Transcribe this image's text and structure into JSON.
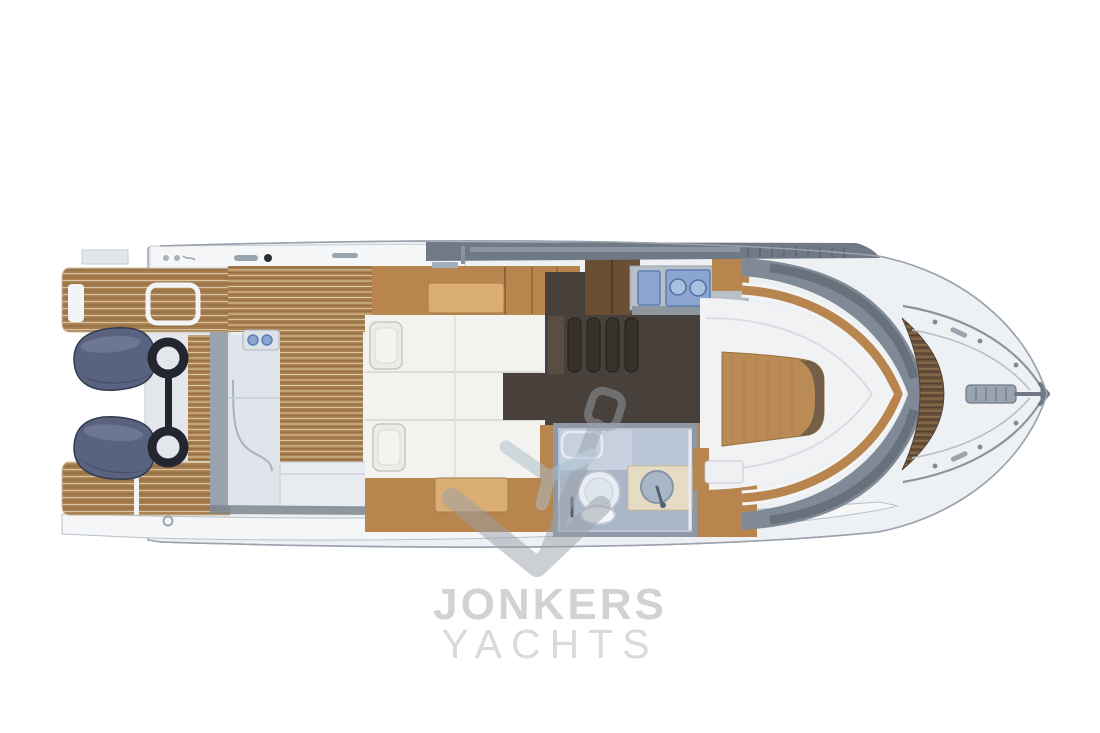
{
  "watermark": {
    "brand_line1": "JONKERS",
    "brand_line2": "YACHTS",
    "logo_icon": "anchor"
  },
  "icons": {
    "watermark_logo": "anchor",
    "engines": "outboard-engine",
    "engine_bracket": "mounting-bracket",
    "deck_hatch": "hatch",
    "wet_bar": "two-burner-grill",
    "galley_sink": "sink",
    "galley_stove": "two-burner-stove",
    "toilet": "toilet",
    "washbasin": "round-basin",
    "berth_pillows": "pillow",
    "companionway": "steps",
    "bow_gear": "anchor-windlass"
  },
  "colors": {
    "teak": "#a87e4e",
    "teak_seam": "#d8c7a6",
    "teak_shadow": "#8a6740",
    "wood": "#b9854e",
    "wood_light": "#d9ad74",
    "wood_dark": "#8f6336",
    "locker_dark": "#6b4f35",
    "dark_floor": "#48403a",
    "dark_step": "#38312b",
    "engine_navy": "#59627f",
    "engine_dark": "#3f4760",
    "engine_light": "#7d86a2",
    "bracket_black": "#23262e",
    "roof_gray": "#707a86",
    "superstructure_gray": "#808a96",
    "superstructure_dark": "#5f6873",
    "hull_line": "#9aa2ac",
    "deck_white": "#eef1f4",
    "panel_white": "#f4f6f8",
    "seam_gray": "#c9ced5",
    "walkway_blue": "#dfe5eb",
    "door_gray": "#9aa3ad",
    "counter_gray": "#b8bfc7",
    "appliance_blue": "#8aa6d0",
    "appliance_blue_dark": "#5c7fb5",
    "bath_wall": "#bac5d5",
    "bath_floor": "#aab6c8",
    "fixture_white": "#e9edf3",
    "vanity_cream": "#e6dcc6",
    "basin_blue": "#a9b6c8",
    "table_wood": "#bb8b55",
    "watermark_gray": "#9aa0a8",
    "watermark_blue": "#a9bfce",
    "brand_bold_gray": "#d2d2d2",
    "brand_light_gray": "#dadada"
  }
}
